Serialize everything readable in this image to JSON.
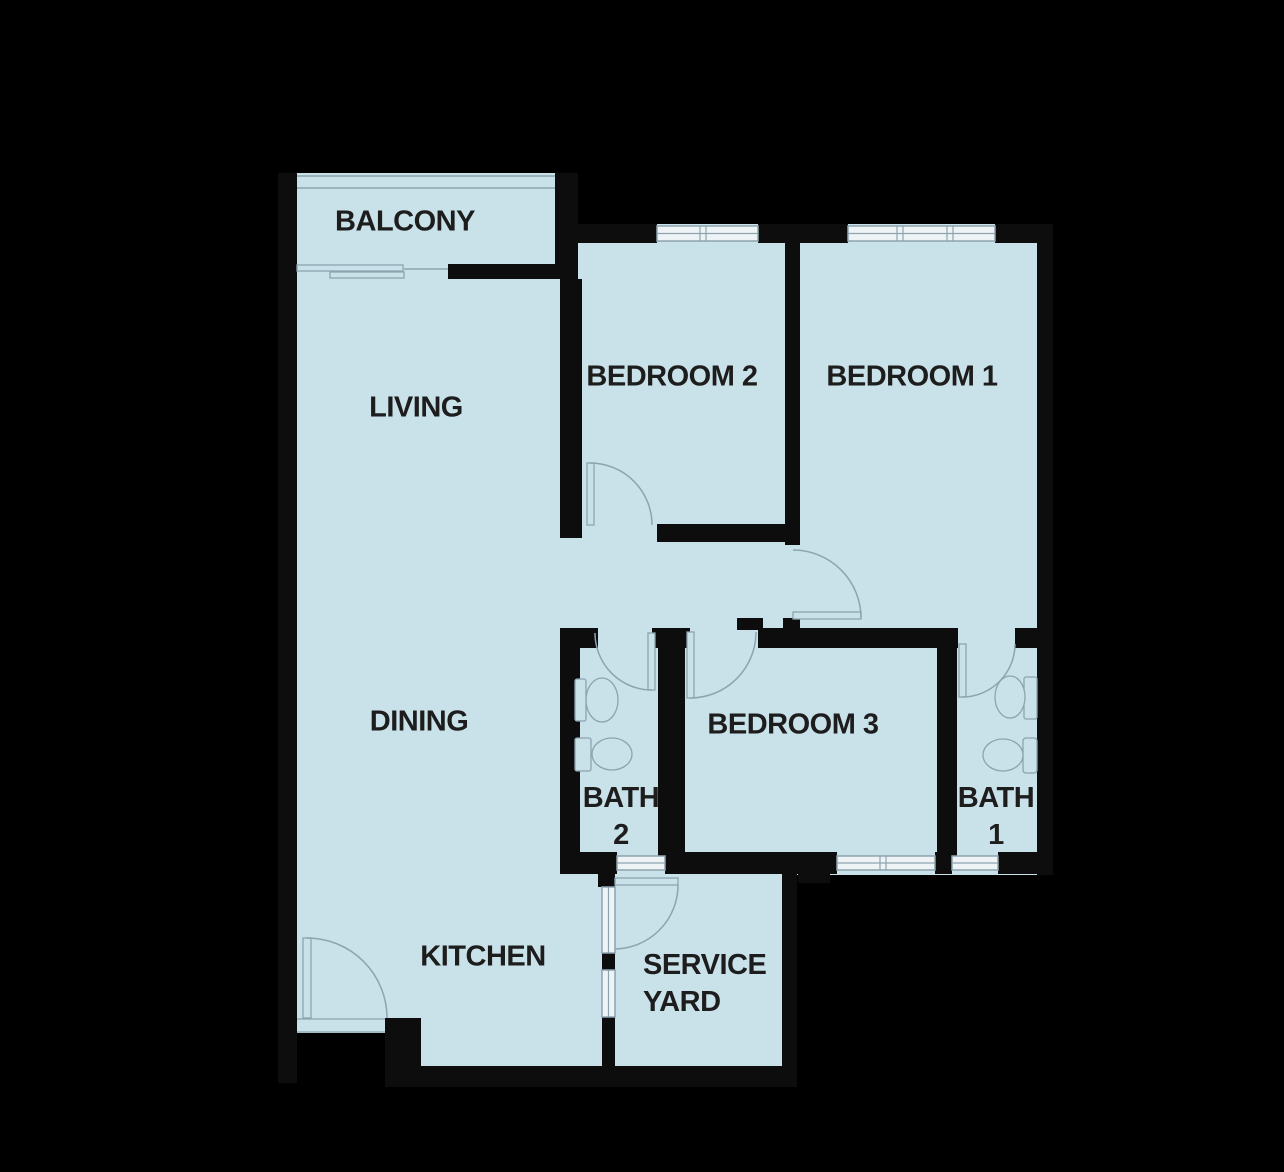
{
  "title": "3-bedroom apartment floor plan",
  "colors": {
    "floor": "#c9e1e9",
    "wall": "#0d0d0d",
    "line": "#8da4af",
    "window": "#eef4f6",
    "label": "#1d1d1d",
    "background": "#000000"
  },
  "rooms": [
    {
      "id": "balcony",
      "label": "BALCONY"
    },
    {
      "id": "living",
      "label": "LIVING"
    },
    {
      "id": "dining",
      "label": "DINING"
    },
    {
      "id": "kitchen",
      "label": "KITCHEN"
    },
    {
      "id": "bedroom-2",
      "label": "BEDROOM 2"
    },
    {
      "id": "bedroom-1",
      "label": "BEDROOM 1"
    },
    {
      "id": "bedroom-3",
      "label": "BEDROOM 3"
    },
    {
      "id": "bath-2",
      "label": "BATH\n2"
    },
    {
      "id": "bath-1",
      "label": "BATH\n1"
    },
    {
      "id": "service-yard",
      "label": "SERVICE\nYARD"
    }
  ]
}
